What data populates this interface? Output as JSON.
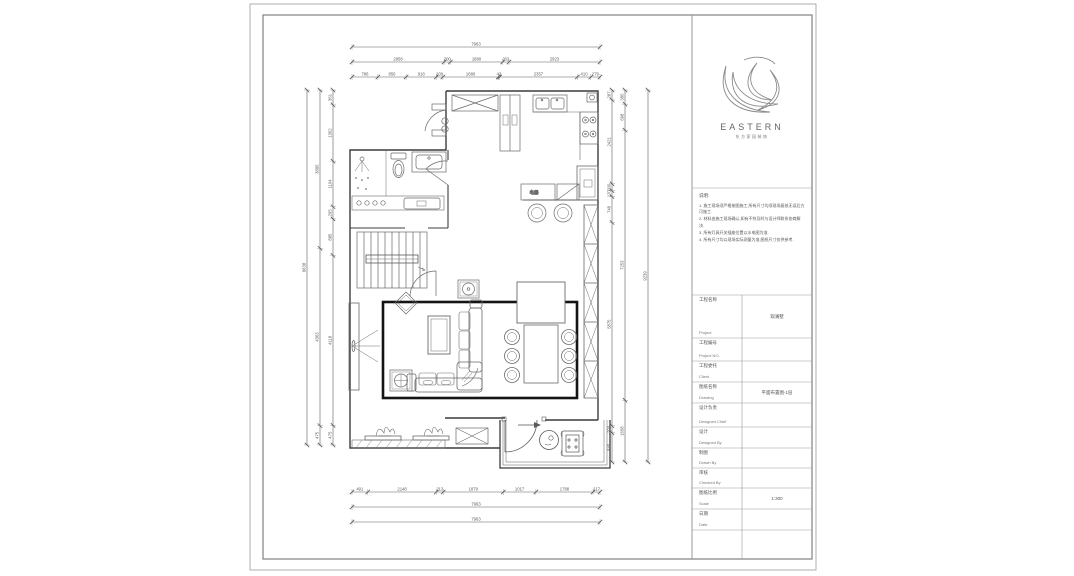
{
  "logo": {
    "brand": "EASTERN",
    "subtitle": "东方家园装饰"
  },
  "notes": {
    "title": "说明:",
    "items": [
      "1. 施工现场须严格按图施工,所有尺寸均须现场复核无误后方可施工.",
      "2. 材料由施工现场确认,如有不符及时与设计师联系协商解决.",
      "3. 所有灯具开关插座位置以水电图为准.",
      "4. 所有尺寸均以现场实际测量为准,图纸尺寸仅供参考."
    ]
  },
  "titleblock": {
    "rows": [
      {
        "cn": "工程名称",
        "en": "Project",
        "value": "观澜墅"
      },
      {
        "cn": "工程编号",
        "en": "Project NO.",
        "value": ""
      },
      {
        "cn": "工程委托",
        "en": "Client",
        "value": ""
      },
      {
        "cn": "图纸名称",
        "en": "Drawing",
        "value": "平面布置图-1层"
      },
      {
        "cn": "设计负责",
        "en": "Designed Chief",
        "value": ""
      },
      {
        "cn": "设计",
        "en": "Designed By",
        "value": ""
      },
      {
        "cn": "制图",
        "en": "Drawn By",
        "value": ""
      },
      {
        "cn": "审核",
        "en": "Checked By",
        "value": ""
      },
      {
        "cn": "图纸比例",
        "en": "Scale",
        "value": "1:300"
      },
      {
        "cn": "日期",
        "en": "Date",
        "value": ""
      }
    ]
  },
  "plan": {
    "island_label": "电器"
  },
  "dimensions": {
    "top": [
      [
        "7963"
      ],
      [
        "2958",
        "200",
        "1680",
        "202",
        "2923"
      ],
      [
        "786",
        "856",
        "918",
        "200",
        "1680",
        "43",
        "2357",
        "410",
        "279"
      ]
    ],
    "bottom": [
      [
        "491",
        "2148",
        "213",
        "1879",
        "1017",
        "1788",
        "217"
      ],
      [
        "7963"
      ],
      [
        "7963"
      ]
    ],
    "left": [
      [
        "9638"
      ],
      [
        "3895",
        "4363",
        "475"
      ],
      [
        "361",
        "1362",
        "1104",
        "295",
        "885",
        "4118",
        "475"
      ]
    ],
    "right": [
      [
        "287",
        "2421",
        "200",
        "170",
        "748",
        "5875",
        "200",
        "845"
      ],
      [
        "380",
        "698",
        "7253",
        "1658"
      ],
      [
        "9239"
      ]
    ]
  },
  "colors": {
    "wall": "#3c3c3c",
    "furniture": "#6a6a6a",
    "rug_border": "#141414",
    "dim": "#5a5a5a",
    "frame": "#8a8a8a"
  }
}
